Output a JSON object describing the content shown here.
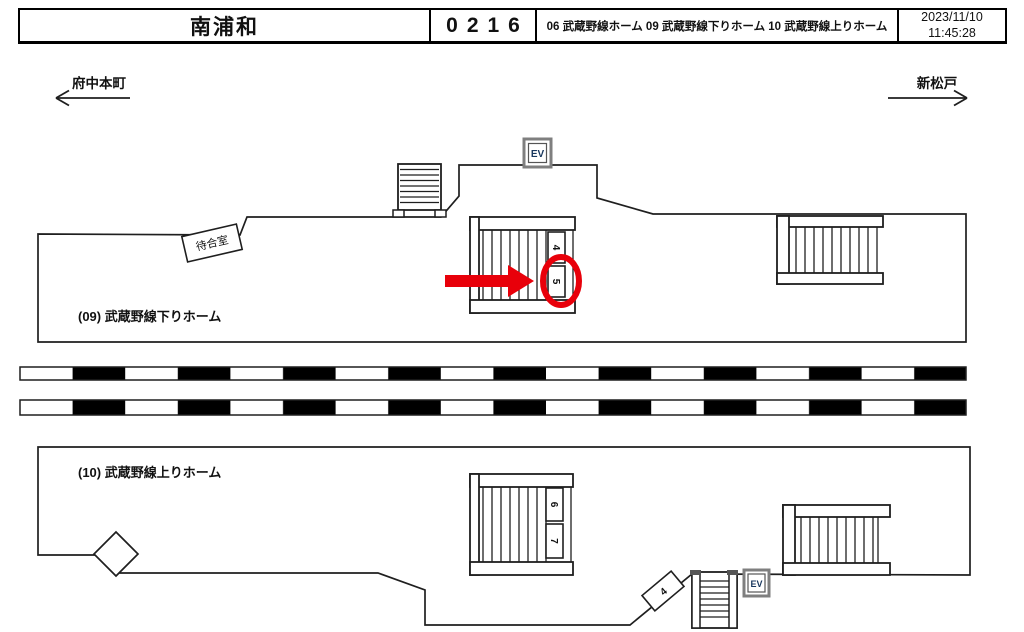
{
  "header": {
    "station_name": "南浦和",
    "board_number": "0216",
    "platform_list": "06 武蔵野線ホーム 09 武蔵野線下りホーム 10 武蔵野線上りホーム",
    "date": "2023/11/10",
    "time": "11:45:28"
  },
  "directions": {
    "left": "府中本町",
    "right": "新松戸"
  },
  "platform_down": {
    "label": "(09) 武蔵野線下りホーム",
    "waiting_room_label": "待合室",
    "ev_label": "EV",
    "markers": [
      "4",
      "5"
    ]
  },
  "platform_up": {
    "label": "(10) 武蔵野線上りホーム",
    "ev_label": "EV",
    "markers": [
      "6",
      "7"
    ],
    "slope_marker": "4"
  },
  "highlight": {
    "circled_marker": "5",
    "color": "#e8000a"
  },
  "colors": {
    "line": "#1f1f1f",
    "ev_border": "#7f7f7f",
    "ev_text": "#17365d"
  }
}
